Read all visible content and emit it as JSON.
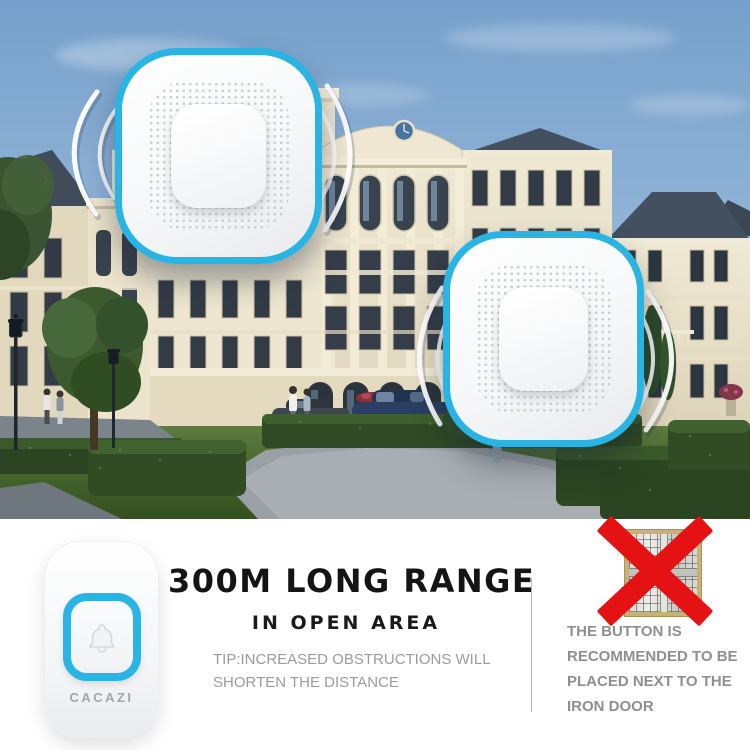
{
  "colors": {
    "accent_cyan": "#29b4e3",
    "alert_red": "#e41212",
    "title_black": "#141414",
    "tip_gray": "#9b9b9b",
    "warning_gray": "#8f8f8f",
    "sky_blue": "#79a2cc"
  },
  "icons": {
    "signal_waves": "signal-waves",
    "bell": "bell-icon",
    "iron_door": "iron-door-icon",
    "red_x": "red-x-mark",
    "speaker_grill": "speaker-grill"
  },
  "transmitter": {
    "brand_label": "CACAZI"
  },
  "headline": {
    "title": "300M LONG RANGE",
    "subtitle": "IN OPEN AREA",
    "tip_line1": "TIP:INCREASED OBSTRUCTIONS WILL",
    "tip_line2": "SHORTEN THE DISTANCE"
  },
  "warning": {
    "line1": "THE BUTTON IS",
    "line2": "RECOMMENDED TO BE",
    "line3": "PLACED NEXT TO THE",
    "line4": "IRON DOOR"
  }
}
